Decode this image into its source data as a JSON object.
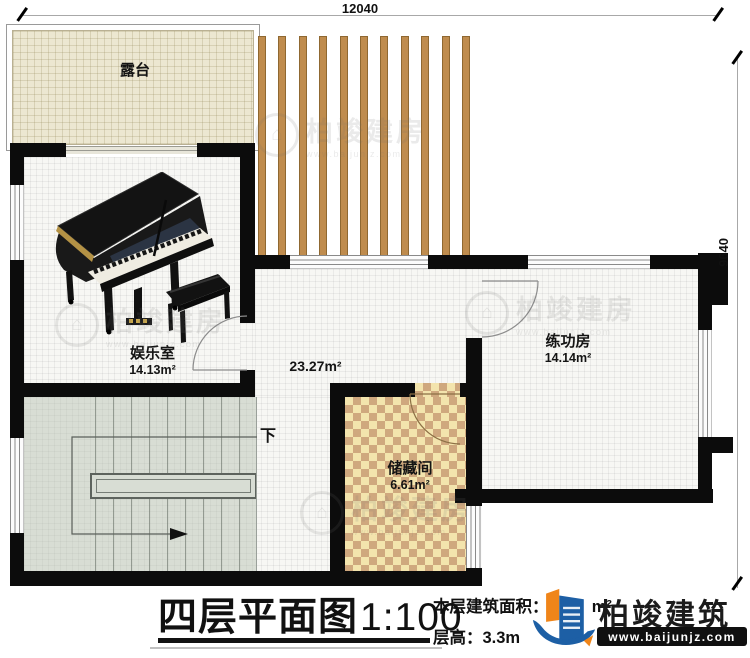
{
  "plan": {
    "dim_top": "12040",
    "dim_right": "9640",
    "rooms": {
      "terrace": {
        "name": "露台"
      },
      "entertainment": {
        "name": "娱乐室",
        "area": "14.13m²"
      },
      "hall": {
        "area": "23.27m²"
      },
      "practice": {
        "name": "练功房",
        "area": "14.14m²"
      },
      "storage": {
        "name": "储藏间",
        "area": "6.61m²"
      }
    },
    "stairs_label": "下"
  },
  "title_block": {
    "title": "四层平面图",
    "scale": "1:100",
    "area_label": "本层建筑面积：",
    "area_value_visible": "7",
    "area_unit": "m²",
    "floor_height_label": "层高：",
    "floor_height_value": "3.3m"
  },
  "logo": {
    "company": "柏竣建筑",
    "website": "www.baijunjz.com"
  },
  "watermark": {
    "text": "柏竣建房",
    "website": "www.baijunjz.com"
  },
  "colors": {
    "wall": "#0c0c0c",
    "terrace_floor": "#ece7d1",
    "stairs_floor": "#d8ddd4",
    "checker_light": "#f3e4ad",
    "checker_dark": "#cfa87e",
    "pergola_slat": "#bf8c4e",
    "logo_blue": "#1d5fa5",
    "logo_orange": "#f08519"
  }
}
